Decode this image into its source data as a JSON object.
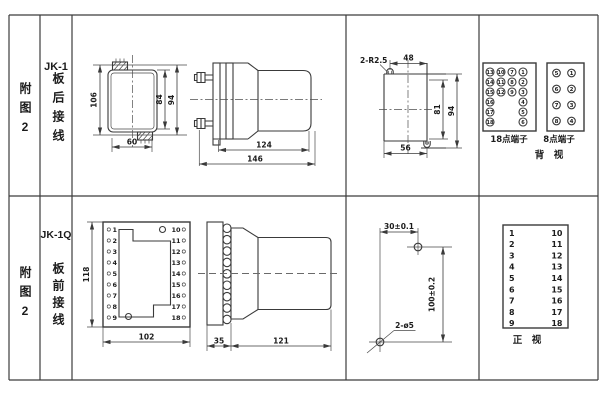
{
  "row1": {
    "fig_label": "附图2",
    "model": "JK-1",
    "wiring": "板后接线",
    "top_view": {
      "dim_height": "106",
      "dim_inner": "84",
      "dim_outer": "94",
      "dim_width": "60"
    },
    "side_view": {
      "dim_body": "124",
      "dim_total": "146"
    },
    "cutout": {
      "slot_label": "2-R2.5",
      "dim_top": "48",
      "dim_inner_height": "81",
      "dim_outer_height": "94",
      "dim_bottom": "56"
    },
    "block18": {
      "label": "18点端子",
      "col_a": [
        "13",
        "14",
        "15",
        "16",
        "17",
        "18"
      ],
      "col_b": [
        "10",
        "11",
        "12"
      ],
      "col_c": [
        "7",
        "8",
        "9"
      ],
      "col_d": [
        "1",
        "2",
        "3",
        "4",
        "5",
        "6"
      ]
    },
    "block8": {
      "label": "8点端子",
      "col_left": [
        "5",
        "6",
        "7",
        "8"
      ],
      "col_right": [
        "1",
        "2",
        "3",
        "4"
      ]
    },
    "view_label": "背　视"
  },
  "row2": {
    "fig_label": "附图2",
    "model": "JK-1Q",
    "wiring": "板前接线",
    "front_view": {
      "dim_height": "118",
      "dim_width": "102",
      "terminals_left": [
        "1",
        "2",
        "3",
        "4",
        "5",
        "6",
        "7",
        "8",
        "9"
      ],
      "terminals_right": [
        "10",
        "11",
        "12",
        "13",
        "14",
        "15",
        "16",
        "17",
        "18"
      ]
    },
    "side_view": {
      "dim_plate": "35",
      "dim_body": "121"
    },
    "drill": {
      "dim_horizontal": "30±0.1",
      "dim_vertical": "100±0.2",
      "hole_label": "2-ø5"
    },
    "terminal_table": {
      "col_left": [
        "1",
        "2",
        "3",
        "4",
        "5",
        "6",
        "7",
        "8",
        "9"
      ],
      "col_right": [
        "10",
        "11",
        "12",
        "13",
        "14",
        "15",
        "16",
        "17",
        "18"
      ]
    },
    "view_label": "正　视"
  }
}
